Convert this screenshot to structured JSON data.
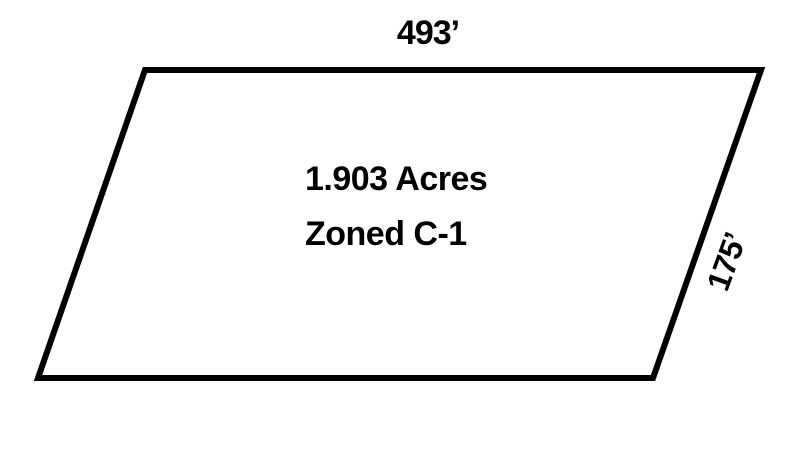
{
  "diagram": {
    "shape": "parallelogram",
    "stroke_color": "#000000",
    "fill_color": "#ffffff",
    "background_color": "#ffffff",
    "top_dimension": "493’",
    "right_dimension": "175’",
    "area_label": "1.903 Acres",
    "zoning_label": "Zoned C-1"
  }
}
